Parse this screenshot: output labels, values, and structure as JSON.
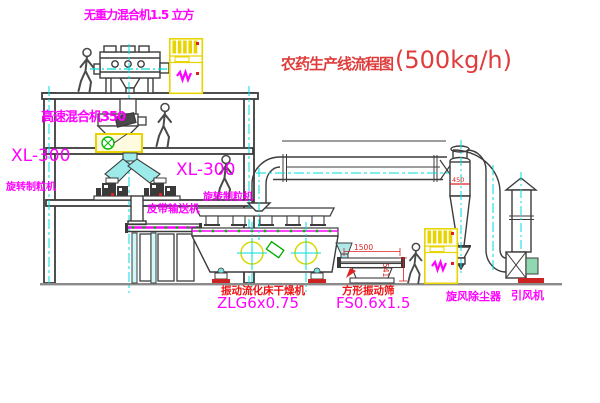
{
  "title": {
    "text": "农药生产线流程图",
    "capacity": "(500kg/h)"
  },
  "equipment": {
    "gravity_mixer": {
      "label": "无重力混合机1.5 立方"
    },
    "high_speed_mixer": {
      "label": "高速混合机350"
    },
    "granulator_left": {
      "model": "XL-300",
      "name": "旋转制粒机"
    },
    "granulator_right": {
      "model": "XL-300",
      "name": "旋转制粒机"
    },
    "belt_conveyor": {
      "name": "皮带输送机"
    },
    "dryer": {
      "name": "振动流化床干燥机",
      "model": "ZLG6x0.75"
    },
    "sieve": {
      "name": "方形振动筛",
      "model": "FS0.6x1.5",
      "dim_width": "1500",
      "dim_height": "541"
    },
    "cyclone": {
      "name": "旋风除尘器",
      "note": "450"
    },
    "fan": {
      "name": "引风机"
    }
  },
  "colors": {
    "label_magenta": "#ff00ff",
    "label_red": "#ee1111",
    "title_red": "#e03c3c",
    "line_dark": "#3c3c3c",
    "centerline_cyan": "#00dede",
    "cabinet_yellow": "#e8d400",
    "dot_green": "#00bb00",
    "ground_gray": "#8a8a8a",
    "base_red": "#cc2222"
  }
}
